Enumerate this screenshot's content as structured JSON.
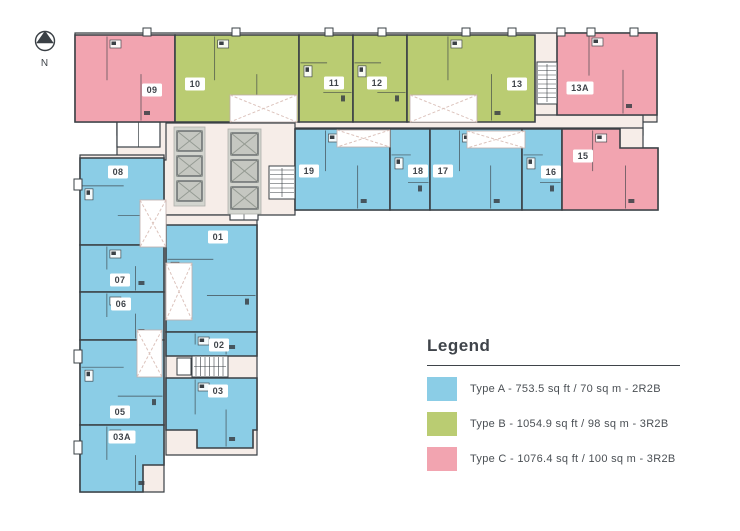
{
  "meta": {
    "width": 740,
    "height": 531
  },
  "colors": {
    "typeA": "#8BCDE6",
    "typeB": "#BACC72",
    "typeC": "#F2A4B0",
    "corridor": "#F6EDE8",
    "wall": "#3A4045",
    "elevator_frame": "#D3D5CF",
    "elevator_car": "#C5C7C1",
    "elevator_x": "#959B93",
    "void_dash": "#DCC3BC",
    "text": "#3F444A",
    "background": "#FFFFFF"
  },
  "north": {
    "label": "N"
  },
  "legend": {
    "title": "Legend",
    "items": [
      {
        "type": "A",
        "color_key": "typeA",
        "label": "Type A - 753.5 sq ft / 70 sq m - 2R2B"
      },
      {
        "type": "B",
        "color_key": "typeB",
        "label": "Type B - 1054.9 sq ft / 98 sq m - 3R2B"
      },
      {
        "type": "C",
        "color_key": "typeC",
        "label": "Type C - 1076.4 sq ft / 100 sq m - 3R2B"
      }
    ]
  },
  "units": [
    {
      "number": "09",
      "type": "C",
      "shape": [
        [
          75,
          35
        ],
        [
          175,
          35
        ],
        [
          175,
          122
        ],
        [
          75,
          122
        ]
      ],
      "label_pos": [
        152,
        90
      ]
    },
    {
      "number": "10",
      "type": "B",
      "shape": [
        [
          175,
          35
        ],
        [
          299,
          35
        ],
        [
          299,
          122
        ],
        [
          175,
          122
        ]
      ],
      "label_pos": [
        195,
        84
      ]
    },
    {
      "number": "11",
      "type": "B",
      "shape": [
        [
          299,
          35
        ],
        [
          353,
          35
        ],
        [
          353,
          122
        ],
        [
          299,
          122
        ]
      ],
      "label_pos": [
        334,
        83
      ]
    },
    {
      "number": "12",
      "type": "B",
      "shape": [
        [
          353,
          35
        ],
        [
          407,
          35
        ],
        [
          407,
          122
        ],
        [
          353,
          122
        ]
      ],
      "label_pos": [
        377,
        83
      ]
    },
    {
      "number": "13",
      "type": "B",
      "shape": [
        [
          407,
          35
        ],
        [
          535,
          35
        ],
        [
          535,
          122
        ],
        [
          407,
          122
        ]
      ],
      "label_pos": [
        517,
        84
      ]
    },
    {
      "number": "13A",
      "type": "C",
      "shape": [
        [
          557,
          33
        ],
        [
          657,
          33
        ],
        [
          657,
          115
        ],
        [
          557,
          115
        ]
      ],
      "label_pos": [
        580,
        88
      ]
    },
    {
      "number": "19",
      "type": "A",
      "shape": [
        [
          295,
          129
        ],
        [
          390,
          129
        ],
        [
          390,
          210
        ],
        [
          295,
          210
        ]
      ],
      "label_pos": [
        309,
        171
      ]
    },
    {
      "number": "18",
      "type": "A",
      "shape": [
        [
          390,
          129
        ],
        [
          430,
          129
        ],
        [
          430,
          210
        ],
        [
          390,
          210
        ]
      ],
      "label_pos": [
        418,
        171
      ]
    },
    {
      "number": "17",
      "type": "A",
      "shape": [
        [
          430,
          129
        ],
        [
          522,
          129
        ],
        [
          522,
          210
        ],
        [
          430,
          210
        ]
      ],
      "label_pos": [
        443,
        171
      ]
    },
    {
      "number": "16",
      "type": "A",
      "shape": [
        [
          522,
          129
        ],
        [
          562,
          129
        ],
        [
          562,
          210
        ],
        [
          522,
          210
        ]
      ],
      "label_pos": [
        551,
        172
      ]
    },
    {
      "number": "15",
      "type": "C",
      "shape": [
        [
          562,
          129
        ],
        [
          620,
          129
        ],
        [
          620,
          148
        ],
        [
          658,
          148
        ],
        [
          658,
          210
        ],
        [
          562,
          210
        ]
      ],
      "label_pos": [
        583,
        156
      ]
    },
    {
      "number": "08",
      "type": "A",
      "shape": [
        [
          80,
          158
        ],
        [
          164,
          158
        ],
        [
          164,
          245
        ],
        [
          80,
          245
        ]
      ],
      "label_pos": [
        118,
        172
      ]
    },
    {
      "number": "07",
      "type": "A",
      "shape": [
        [
          80,
          245
        ],
        [
          164,
          245
        ],
        [
          164,
          292
        ],
        [
          80,
          292
        ]
      ],
      "label_pos": [
        120,
        280
      ]
    },
    {
      "number": "06",
      "type": "A",
      "shape": [
        [
          80,
          292
        ],
        [
          164,
          292
        ],
        [
          164,
          340
        ],
        [
          80,
          340
        ]
      ],
      "label_pos": [
        121,
        304
      ]
    },
    {
      "number": "05",
      "type": "A",
      "shape": [
        [
          80,
          340
        ],
        [
          164,
          340
        ],
        [
          164,
          425
        ],
        [
          80,
          425
        ]
      ],
      "label_pos": [
        120,
        412
      ]
    },
    {
      "number": "03A",
      "type": "A",
      "shape": [
        [
          80,
          425
        ],
        [
          164,
          425
        ],
        [
          164,
          465
        ],
        [
          143,
          465
        ],
        [
          143,
          492
        ],
        [
          80,
          492
        ]
      ],
      "label_pos": [
        122,
        437
      ]
    },
    {
      "number": "01",
      "type": "A",
      "shape": [
        [
          166,
          225
        ],
        [
          257,
          225
        ],
        [
          257,
          332
        ],
        [
          166,
          332
        ]
      ],
      "label_pos": [
        218,
        237
      ]
    },
    {
      "number": "02",
      "type": "A",
      "shape": [
        [
          166,
          332
        ],
        [
          257,
          332
        ],
        [
          257,
          356
        ],
        [
          166,
          356
        ]
      ],
      "label_pos": [
        219,
        345
      ]
    },
    {
      "number": "03",
      "type": "A",
      "shape": [
        [
          166,
          378
        ],
        [
          257,
          378
        ],
        [
          257,
          430
        ],
        [
          253,
          430
        ],
        [
          253,
          448
        ],
        [
          197,
          448
        ],
        [
          197,
          430
        ],
        [
          166,
          430
        ]
      ],
      "label_pos": [
        218,
        391
      ]
    }
  ],
  "common_areas": [
    {
      "name": "top-wing-base",
      "shape": [
        [
          75,
          33
        ],
        [
          657,
          33
        ],
        [
          657,
          122
        ],
        [
          75,
          122
        ]
      ]
    },
    {
      "name": "main-corridor",
      "shape": [
        [
          117,
          115
        ],
        [
          643,
          115
        ],
        [
          643,
          135
        ],
        [
          117,
          135
        ]
      ]
    },
    {
      "name": "second-row-base",
      "shape": [
        [
          295,
          128
        ],
        [
          643,
          128
        ],
        [
          643,
          148
        ],
        [
          658,
          148
        ],
        [
          658,
          210
        ],
        [
          295,
          210
        ]
      ]
    },
    {
      "name": "elevator-lobby",
      "shape": [
        [
          160,
          123
        ],
        [
          295,
          123
        ],
        [
          295,
          215
        ],
        [
          160,
          215
        ]
      ]
    },
    {
      "name": "wing-connector",
      "shape": [
        [
          117,
          120
        ],
        [
          166,
          120
        ],
        [
          166,
          160
        ],
        [
          117,
          160
        ]
      ]
    },
    {
      "name": "wing-left-strip",
      "shape": [
        [
          80,
          155
        ],
        [
          164,
          155
        ],
        [
          164,
          492
        ],
        [
          80,
          492
        ]
      ]
    },
    {
      "name": "wing-right-strip",
      "shape": [
        [
          166,
          215
        ],
        [
          257,
          215
        ],
        [
          257,
          455
        ],
        [
          166,
          455
        ]
      ]
    }
  ],
  "service_rooms": [
    {
      "x": 117,
      "y": 122,
      "w": 43,
      "h": 25
    },
    {
      "x": 230,
      "y": 202,
      "w": 28,
      "h": 18
    }
  ],
  "voids": [
    {
      "x": 230,
      "y": 95,
      "w": 67,
      "h": 27
    },
    {
      "x": 410,
      "y": 95,
      "w": 67,
      "h": 27
    },
    {
      "x": 337,
      "y": 130,
      "w": 53,
      "h": 17
    },
    {
      "x": 467,
      "y": 131,
      "w": 58,
      "h": 17
    },
    {
      "x": 140,
      "y": 200,
      "w": 26,
      "h": 47
    },
    {
      "x": 166,
      "y": 263,
      "w": 26,
      "h": 57
    },
    {
      "x": 137,
      "y": 330,
      "w": 25,
      "h": 47
    }
  ],
  "stairs": [
    {
      "x": 537,
      "y": 62,
      "w": 20,
      "h": 42,
      "dir": "h"
    },
    {
      "x": 269,
      "y": 166,
      "w": 26,
      "h": 33,
      "dir": "h"
    },
    {
      "x": 192,
      "y": 356,
      "w": 36,
      "h": 21,
      "dir": "v"
    },
    {
      "x": 177,
      "y": 358,
      "w": 14,
      "h": 17,
      "dir": "none"
    }
  ],
  "elevator_banks": [
    {
      "frame": [
        174,
        127,
        31,
        79
      ],
      "cars": [
        [
          177,
          131,
          25,
          20
        ],
        [
          177,
          156,
          25,
          20
        ],
        [
          177,
          181,
          25,
          20
        ]
      ]
    },
    {
      "frame": [
        228,
        129,
        33,
        85
      ],
      "cars": [
        [
          231,
          133,
          27,
          22
        ],
        [
          231,
          160,
          27,
          22
        ],
        [
          231,
          187,
          27,
          22
        ]
      ]
    }
  ],
  "column_ticks": [
    143,
    232,
    325,
    378,
    462,
    508,
    557,
    587,
    630
  ],
  "edge_bumps": [
    {
      "x": 74,
      "y": 179,
      "w": 8,
      "h": 11
    },
    {
      "x": 74,
      "y": 350,
      "w": 8,
      "h": 13
    },
    {
      "x": 74,
      "y": 441,
      "w": 8,
      "h": 13
    }
  ]
}
